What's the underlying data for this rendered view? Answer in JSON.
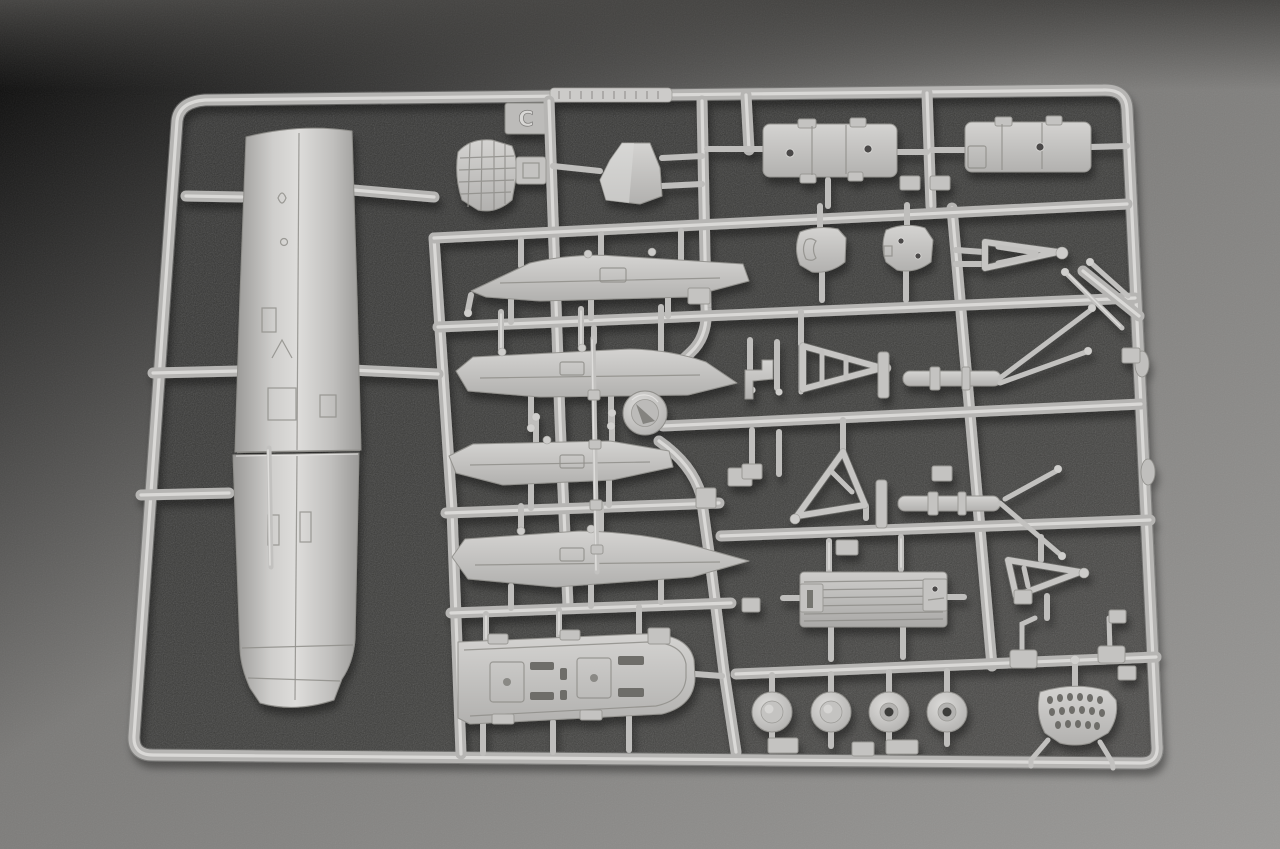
{
  "scene": {
    "type": "photograph",
    "subject": "grey injection-moulded plastic model-kit sprue (parts tree) lying on a dark textured surface",
    "sprue": {
      "letter": "C",
      "molding_text_strip": "unreadable raised molding text on top rail",
      "plastic_color": "#c2c1bf",
      "plastic_highlight": "#e0dfdd",
      "plastic_shadow": "#8a8987"
    },
    "surface": {
      "inside_frame_color": "#3a3a38",
      "outside_top_left_color": "#6b6a68",
      "outside_bottom_right_color": "#989795",
      "top_band_color": "#454442"
    },
    "parts": [
      "fuselage-half",
      "radiator-grille",
      "intake-cover-bell",
      "hatch-panel-left",
      "hatch-panel-right",
      "small-door-left",
      "small-door-right",
      "a-frame-strut-top",
      "diagonal-link-rods",
      "stabilizer-row-1",
      "stabilizer-row-2",
      "stabilizer-row-3",
      "stabilizer-row-4",
      "round-cap-disc",
      "collared-push-rod",
      "hook-bracket-small",
      "a-frame-strut-mid-left",
      "cylinder-strut-mid-right",
      "a-frame-strut-lower-left",
      "cylinder-strut-lower-right",
      "cockpit-floor-tray",
      "grooved-ramp-plate",
      "a-frame-strut-small",
      "hook-lever",
      "flag-lever",
      "wheel-hub-domed-1",
      "wheel-hub-domed-2",
      "wheel-hub-holed-3",
      "wheel-hub-holed-4",
      "perforated-bracket"
    ]
  }
}
